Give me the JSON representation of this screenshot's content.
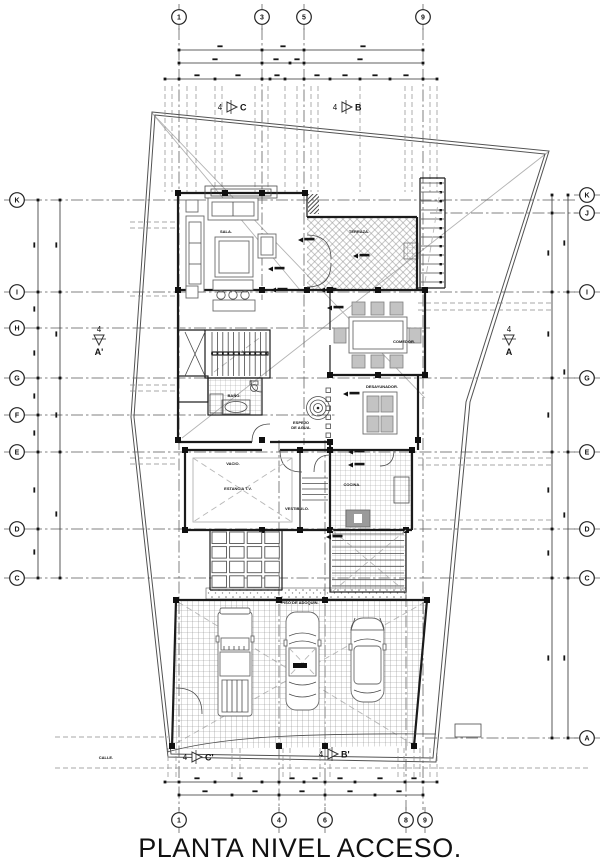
{
  "title": "PLANTA NIVEL ACCESO.",
  "accent_color": "#111111",
  "paper_color": "#ffffff",
  "axes": {
    "top": [
      {
        "label": "1",
        "x": 179
      },
      {
        "label": "3",
        "x": 262
      },
      {
        "label": "5",
        "x": 304
      },
      {
        "label": "9",
        "x": 423
      }
    ],
    "bottom": [
      {
        "label": "1",
        "x": 179
      },
      {
        "label": "4",
        "x": 279
      },
      {
        "label": "6",
        "x": 325
      },
      {
        "label": "8",
        "x": 406
      },
      {
        "label": "9",
        "x": 425
      }
    ],
    "left": [
      {
        "label": "K",
        "y": 200
      },
      {
        "label": "I",
        "y": 292
      },
      {
        "label": "H",
        "y": 328
      },
      {
        "label": "G",
        "y": 378
      },
      {
        "label": "F",
        "y": 415
      },
      {
        "label": "E",
        "y": 452
      },
      {
        "label": "D",
        "y": 529
      },
      {
        "label": "C",
        "y": 578
      }
    ],
    "right": [
      {
        "label": "K",
        "y": 195
      },
      {
        "label": "J",
        "y": 213
      },
      {
        "label": "I",
        "y": 292
      },
      {
        "label": "G",
        "y": 378
      },
      {
        "label": "E",
        "y": 452
      },
      {
        "label": "D",
        "y": 529
      },
      {
        "label": "C",
        "y": 578
      },
      {
        "label": "A",
        "y": 738
      }
    ]
  },
  "section_markers": [
    {
      "num": "4",
      "label": "C",
      "x": 232,
      "y": 107,
      "dir": "right"
    },
    {
      "num": "4",
      "label": "B",
      "x": 347,
      "y": 107,
      "dir": "right"
    },
    {
      "num": "4",
      "label": "A'",
      "x": 99,
      "y": 340,
      "dir": "down"
    },
    {
      "num": "4",
      "label": "A",
      "x": 509,
      "y": 340,
      "dir": "down"
    },
    {
      "num": "4",
      "label": "C'",
      "x": 197,
      "y": 757,
      "dir": "right"
    },
    {
      "num": "4",
      "label": "B'",
      "x": 333,
      "y": 754,
      "dir": "right"
    }
  ],
  "room_labels": [
    {
      "text": "SALA.",
      "x": 226,
      "y": 233
    },
    {
      "text": "TERRAZA.",
      "x": 359,
      "y": 233
    },
    {
      "text": "COMEDOR.",
      "x": 404,
      "y": 343
    },
    {
      "text": "COCINA.",
      "x": 352,
      "y": 486
    },
    {
      "text": "ESTANCIA T.V.",
      "x": 238,
      "y": 490
    },
    {
      "text": "VACIO.",
      "x": 233,
      "y": 465
    },
    {
      "text": "VESTIBULO.",
      "x": 297,
      "y": 510
    },
    {
      "text": "ESPEJO",
      "x": 301,
      "y": 424
    },
    {
      "text": "DE AGUA.",
      "x": 301,
      "y": 429
    },
    {
      "text": "DESAYUNADOR.",
      "x": 382,
      "y": 388
    },
    {
      "text": "BAÑO.",
      "x": 234,
      "y": 397
    },
    {
      "text": "PISO DE ADOQUIN.",
      "x": 300,
      "y": 604
    },
    {
      "text": "CALLE.",
      "x": 106,
      "y": 759
    }
  ]
}
